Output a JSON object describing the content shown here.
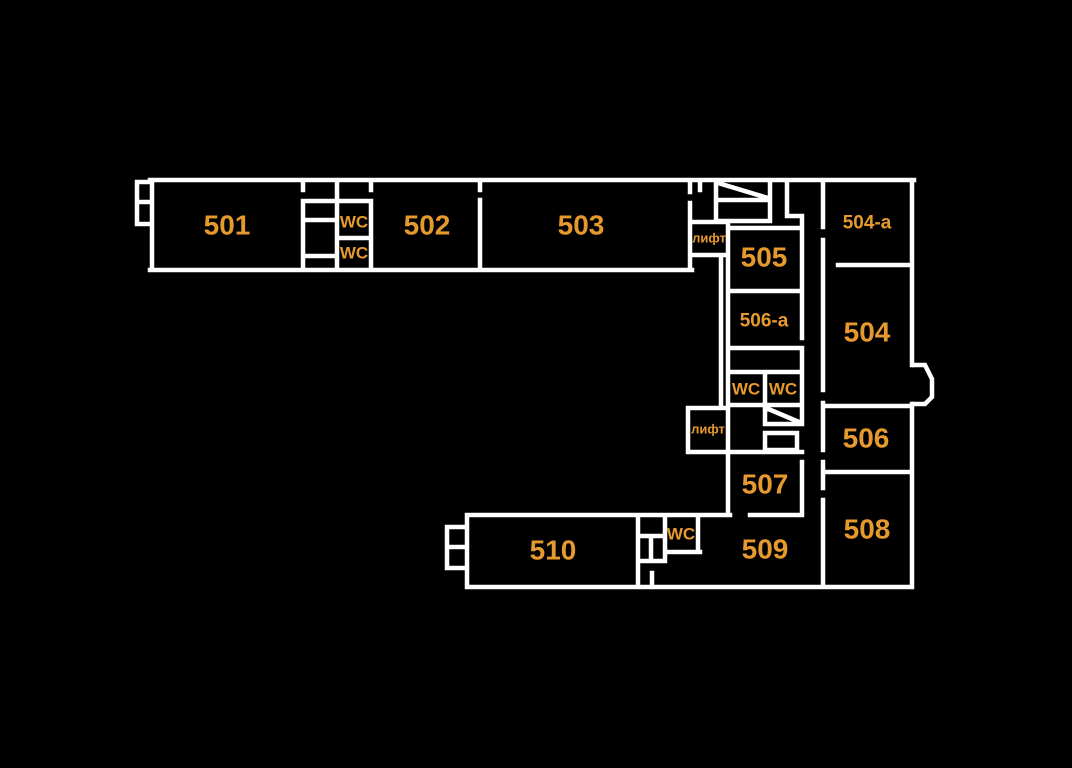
{
  "colors": {
    "background": "#000000",
    "wall": "#ffffff",
    "label": "#e69a2e"
  },
  "floor_plan": {
    "description": "Building floor plan, 5th floor, rooms 501-510",
    "labels": [
      {
        "kind": "room",
        "label": "501",
        "x": 227,
        "y": 225,
        "size": 28
      },
      {
        "kind": "room",
        "label": "502",
        "x": 427,
        "y": 225,
        "size": 28
      },
      {
        "kind": "room",
        "label": "503",
        "x": 581,
        "y": 225,
        "size": 28
      },
      {
        "kind": "wc",
        "label": "WC",
        "x": 354,
        "y": 222,
        "size": 17
      },
      {
        "kind": "wc",
        "label": "WC",
        "x": 354,
        "y": 253,
        "size": 17
      },
      {
        "kind": "elevator",
        "label": "лифт",
        "x": 709,
        "y": 238,
        "size": 13
      },
      {
        "kind": "room",
        "label": "505",
        "x": 764,
        "y": 257,
        "size": 28
      },
      {
        "kind": "room",
        "label": "504-a",
        "x": 867,
        "y": 223,
        "size": 19
      },
      {
        "kind": "room",
        "label": "504",
        "x": 867,
        "y": 332,
        "size": 28
      },
      {
        "kind": "room",
        "label": "506-a",
        "x": 764,
        "y": 321,
        "size": 19
      },
      {
        "kind": "wc",
        "label": "WC",
        "x": 746,
        "y": 389,
        "size": 17
      },
      {
        "kind": "wc",
        "label": "WC",
        "x": 783,
        "y": 389,
        "size": 17
      },
      {
        "kind": "elevator",
        "label": "лифт",
        "x": 708,
        "y": 429,
        "size": 13
      },
      {
        "kind": "room",
        "label": "506",
        "x": 866,
        "y": 438,
        "size": 28
      },
      {
        "kind": "room",
        "label": "507",
        "x": 765,
        "y": 484,
        "size": 28
      },
      {
        "kind": "room",
        "label": "508",
        "x": 867,
        "y": 529,
        "size": 28
      },
      {
        "kind": "room",
        "label": "509",
        "x": 765,
        "y": 549,
        "size": 28
      },
      {
        "kind": "room",
        "label": "510",
        "x": 553,
        "y": 550,
        "size": 28
      },
      {
        "kind": "wc",
        "label": "WC",
        "x": 681,
        "y": 534,
        "size": 17
      }
    ]
  }
}
